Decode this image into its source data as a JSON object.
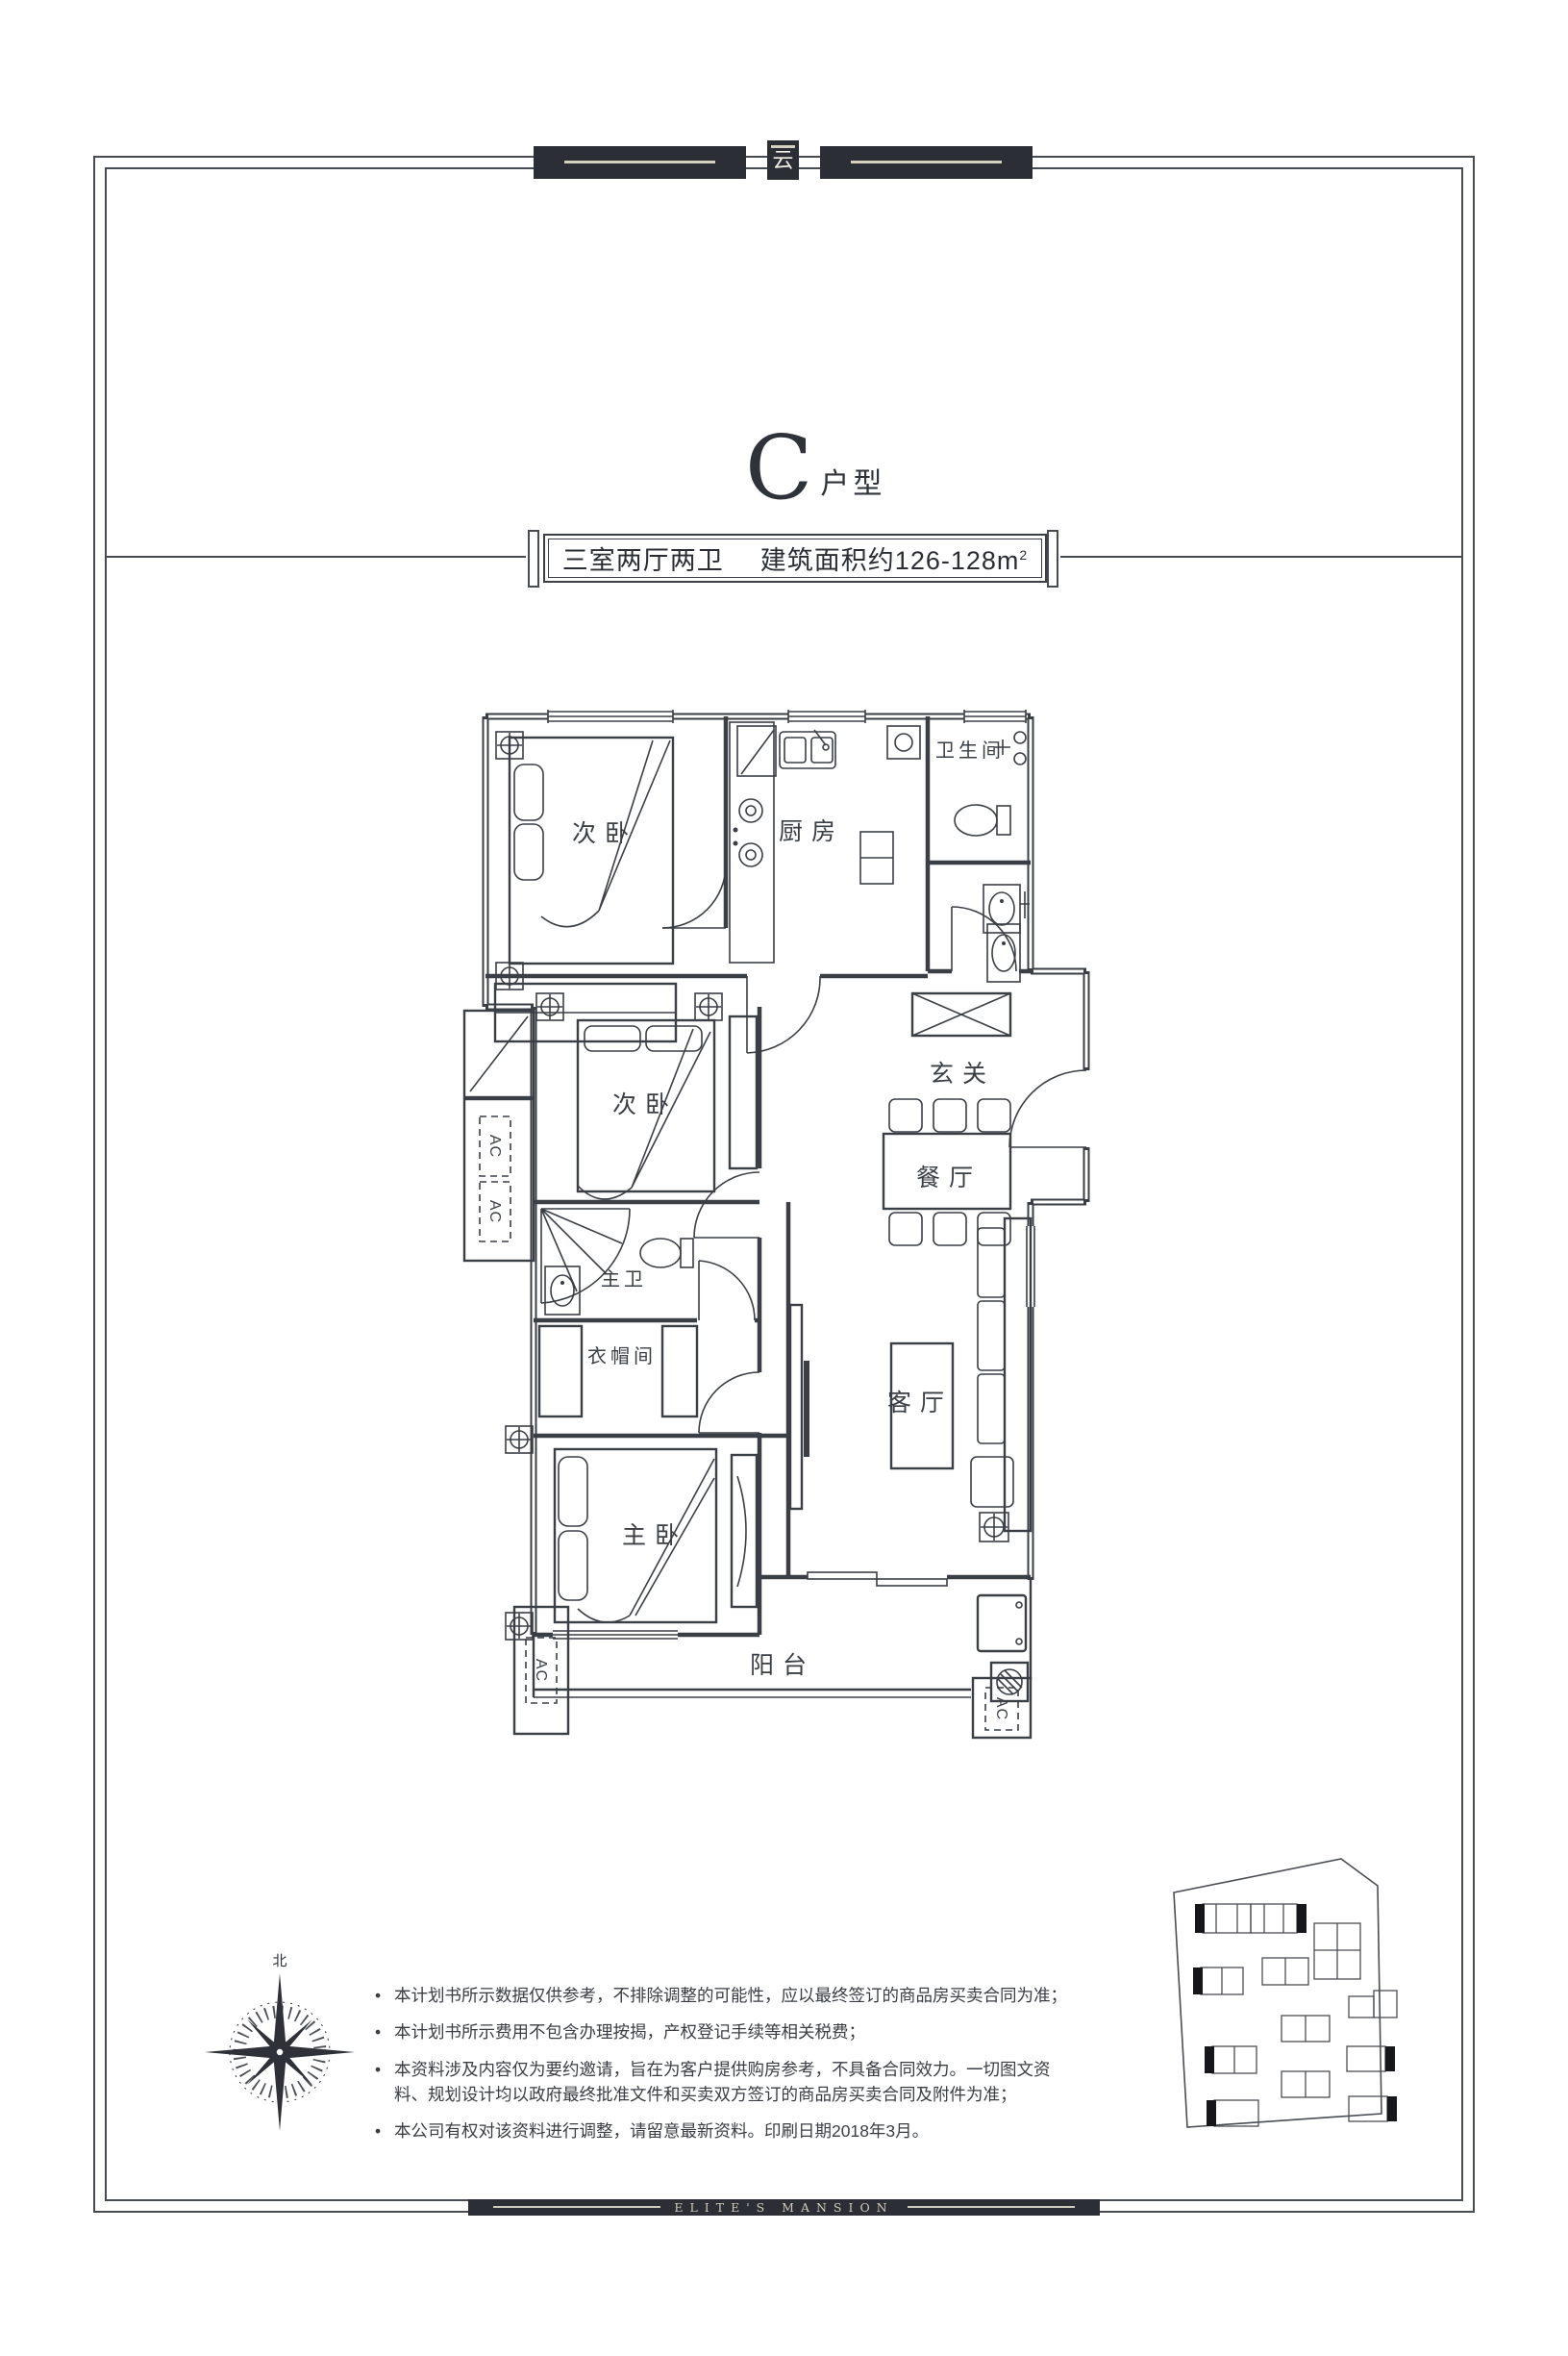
{
  "header": {
    "emblem_glyph": "云"
  },
  "title": {
    "letter": "C",
    "suffix": "户型"
  },
  "spec_bar": {
    "layout": "三室两厅两卫",
    "area": "建筑面积约126-128m",
    "area_sup": "2"
  },
  "floorplan": {
    "labels": {
      "bedroom_top": "次卧",
      "kitchen": "厨房",
      "bathroom": "卫生间",
      "foyer": "玄关",
      "bedroom_mid": "次卧",
      "dining": "餐厅",
      "master_bath": "主卫",
      "cloakroom": "衣帽间",
      "living": "客厅",
      "master_bedroom": "主卧",
      "balcony": "阳台",
      "ac": "AC"
    },
    "compass_north": "北"
  },
  "disclaimer": {
    "items": [
      "本计划书所示数据仅供参考，不排除调整的可能性，应以最终签订的商品房买卖合同为准；",
      "本计划书所示费用不包含办理按揭，产权登记手续等相关税费；",
      "本资料涉及内容仅为要约邀请，旨在为客户提供购房参考，不具备合同效力。一切图文资料、规划设计均以政府最终批准文件和买卖双方签订的商品房买卖合同及附件为准；",
      "本公司有权对该资料进行调整，请留意最新资料。印刷日期2018年3月。"
    ]
  },
  "footer": {
    "brand": "ELITE'S MANSION"
  },
  "colors": {
    "line": "#3a3f46",
    "bar_dark": "#2b2e35",
    "stripe_cream": "#d6d0bf",
    "text_dark": "#33373d"
  }
}
